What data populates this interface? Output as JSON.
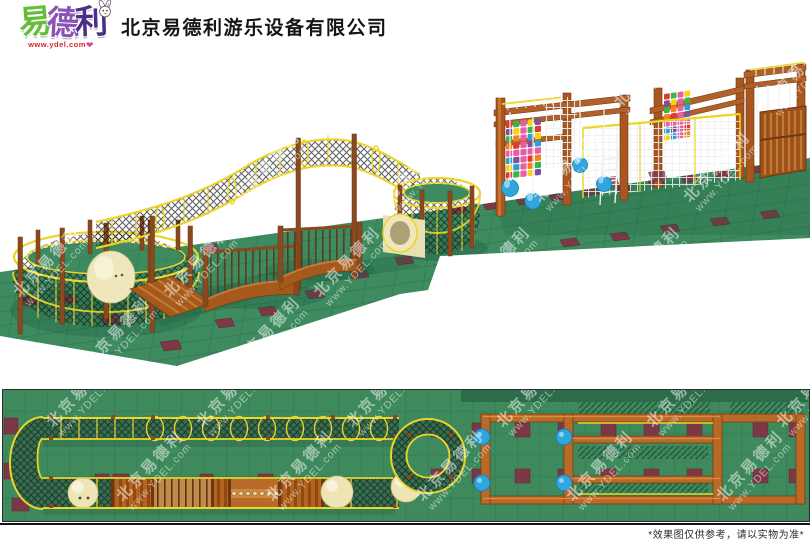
{
  "header": {
    "logo": {
      "chars": [
        "易",
        "德",
        "利"
      ],
      "url": "www.ydel.com",
      "heart": "❤",
      "mascot": "rabbit-icon"
    },
    "company_name": "北京易德利游乐设备有限公司"
  },
  "watermark": {
    "line1": "北京易德利",
    "line2": "www.YDEL.com"
  },
  "views": {
    "main_view": "3d-effect-render",
    "bottom_view": "top-floor-plan"
  },
  "footer": {
    "disclaimer": "*效果图仅供参考，请以实物为准*"
  },
  "colors": {
    "mat_green": "#3e8b60",
    "grid_green": "#2e7450",
    "tile_maroon": "#7d3847",
    "rope_yellow": "#ecd52a",
    "wood": "#a9571f",
    "wood_light": "#cd7c36",
    "wood_dark": "#6f3610",
    "cream": "#efe6bc",
    "ball_blue": "#2fa7de",
    "climb_palette": [
      "#e03a2f",
      "#f5821f",
      "#f7d117",
      "#3bb54a",
      "#2e9fd4",
      "#7d4fa0",
      "#e65fa2"
    ]
  }
}
